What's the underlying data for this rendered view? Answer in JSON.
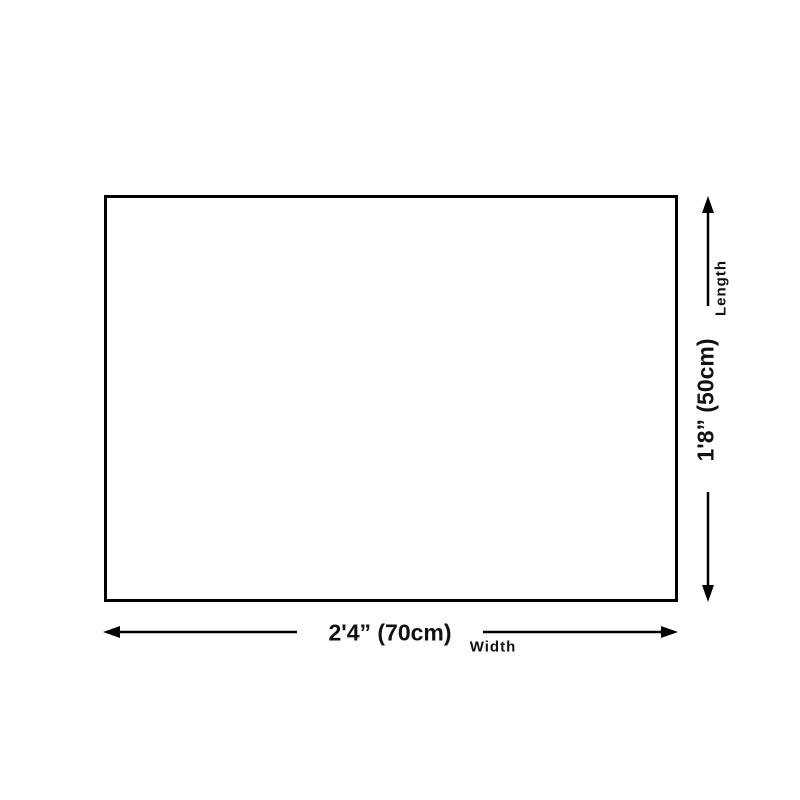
{
  "page": {
    "background_color": "#ffffff",
    "content": "product-size-diagram"
  },
  "diagram": {
    "shape": "rectangle",
    "rect_fill": "#ffffff",
    "line_color": "#000000",
    "text_color": "#111111",
    "width_dimension": {
      "value": "2'4” (70cm)",
      "caption": "Width",
      "cm": 70
    },
    "length_dimension": {
      "value": "1'8” (50cm)",
      "caption": "Length",
      "cm": 50
    }
  }
}
